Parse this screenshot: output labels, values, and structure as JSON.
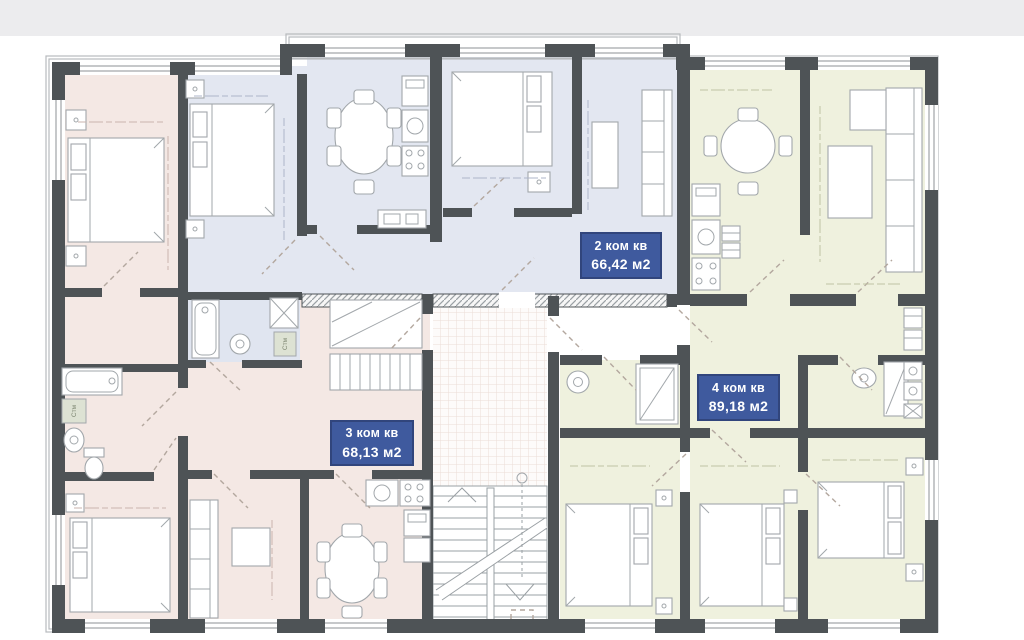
{
  "apartment_labels": {
    "apt2": {
      "rooms": "2 ком кв",
      "area": "66,42 м2"
    },
    "apt3": {
      "rooms": "3 ком кв",
      "area": "68,13 м2"
    },
    "apt4": {
      "rooms": "4 ком кв",
      "area": "89,18 м2"
    }
  },
  "fixture_labels": {
    "washer_bath_left": "Стм",
    "washer_bath_middle": "Стм"
  },
  "colors": {
    "paper": "#ffffff",
    "top_band": "#ececee",
    "wall": "#4e5356",
    "pink": "#f4e8e4",
    "blue": "#e3e7f1",
    "blue_bath": "#e0e5f0",
    "green": "#eff1de",
    "frame": "#b7babd",
    "furn": "#a2a7ab",
    "label_bg": "#3f5a9e",
    "label_border": "#31457c",
    "door_dash": "#b3a79e",
    "grid_line": "#ecdcd7",
    "hatch_line": "#9aa0a4",
    "washer_box": "#dde2d3",
    "washer_text": "#78806c",
    "micro_pink": "#c9b3ad",
    "micro_blue": "#aeb5c9",
    "micro_green": "#bfc3a3"
  }
}
